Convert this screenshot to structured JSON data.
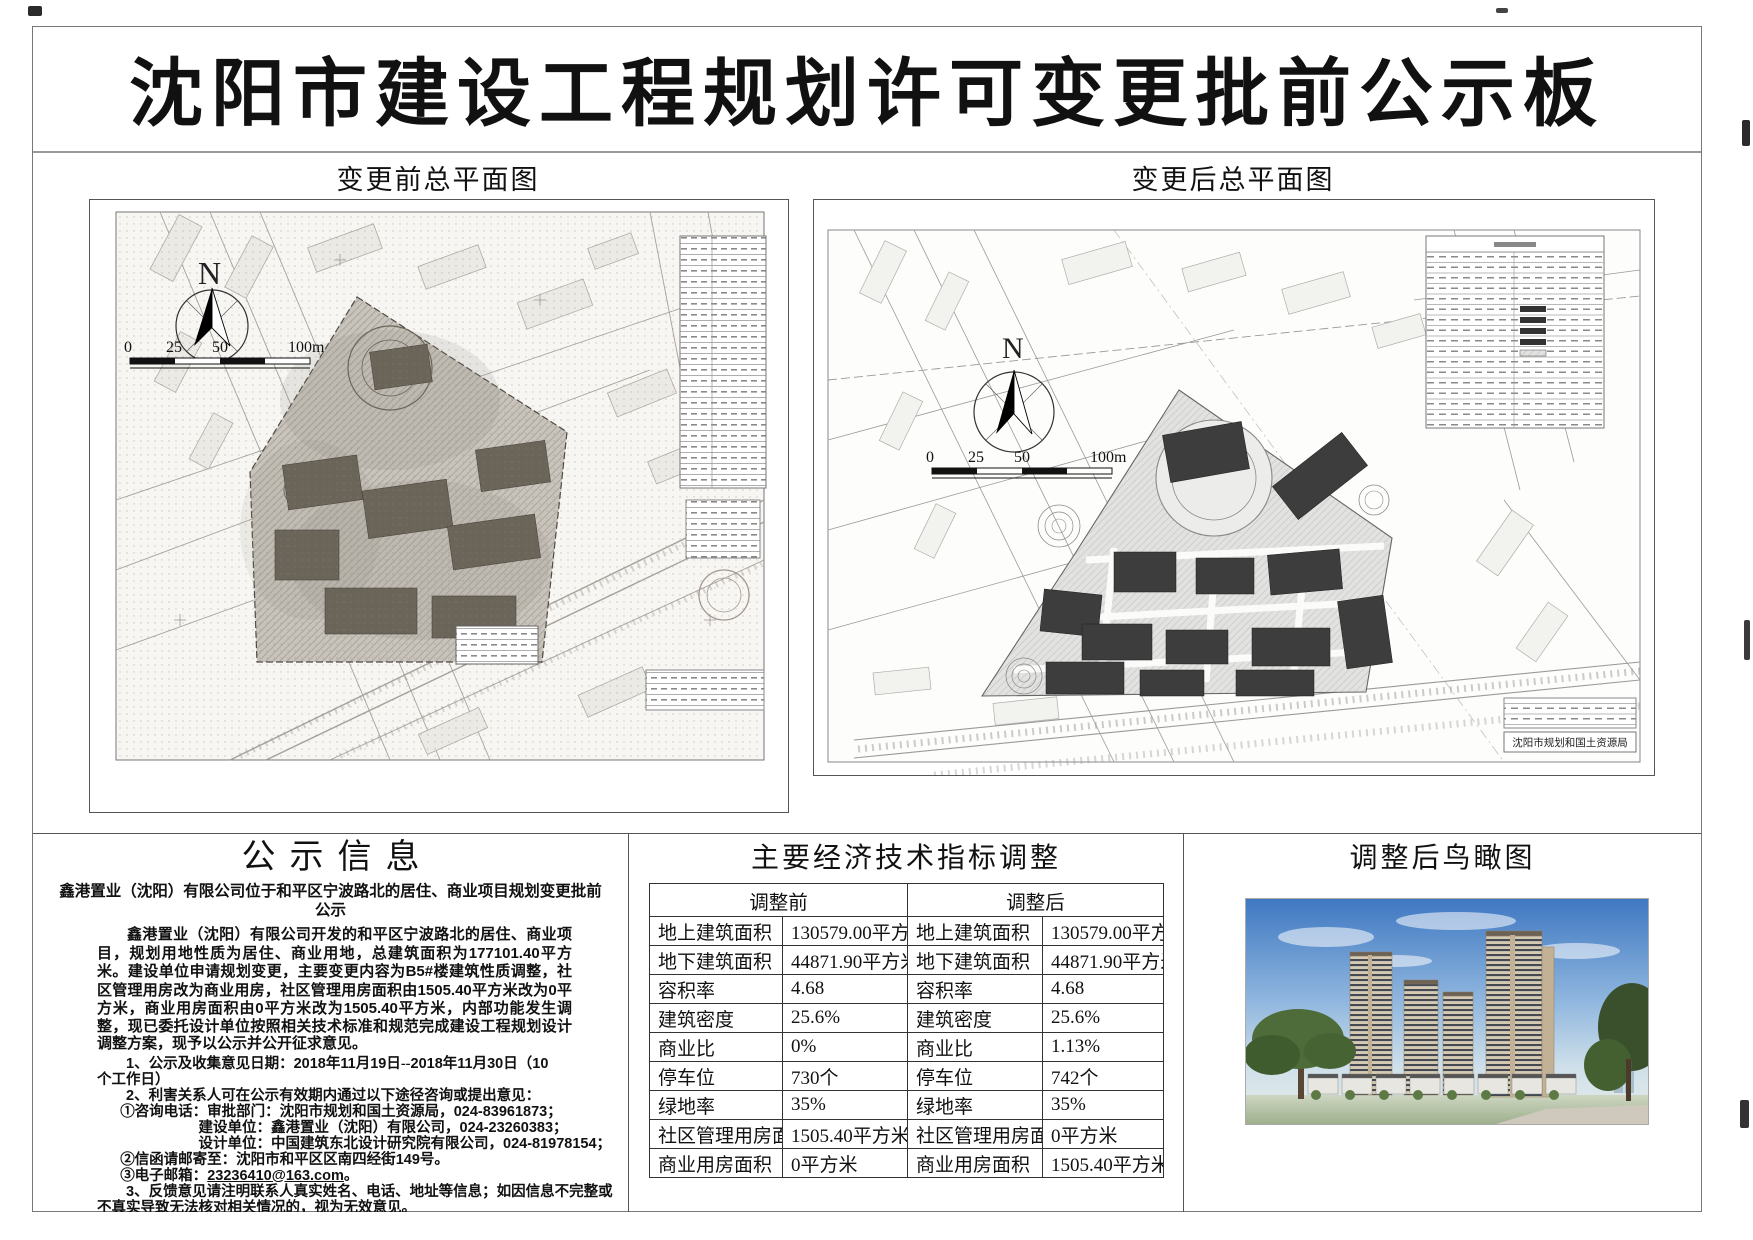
{
  "page": {
    "title": "沈阳市建设工程规划许可变更批前公示板"
  },
  "plans": {
    "before": {
      "title": "变更前总平面图",
      "north": "N",
      "scale": [
        "0",
        "25",
        "50",
        "100m"
      ]
    },
    "after": {
      "title": "变更后总平面图",
      "north": "N",
      "scale": [
        "0",
        "25",
        "50",
        "100m"
      ],
      "agency": "沈阳市规划和国土资源局"
    }
  },
  "notice": {
    "title": "公示信息",
    "subtitle": "鑫港置业（沈阳）有限公司位于和平区宁波路北的居住、商业项目规划变更批前公示",
    "paragraph": "鑫港置业（沈阳）有限公司开发的和平区宁波路北的居住、商业项目，规划用地性质为居住、商业用地，总建筑面积为177101.40平方米。建设单位申请规划变更，主要变更内容为B5#楼建筑性质调整，社区管理用房改为商业用房，社区管理用房面积由1505.40平方米改为0平方米，商业用房面积由0平方米改为1505.40平方米，内部功能发生调整，现已委托设计单位按照相关技术标准和规范完成建设工程规划设计调整方案，现予以公示并公开征求意见。",
    "items": [
      {
        "text": "1、公示及收集意见日期：2018年11月19日--2018年11月30日（10个工作日）",
        "indent": 2
      },
      {
        "text": "2、利害关系人可在公示有效期内通过以下途径咨询或提出意见：",
        "indent": 2
      },
      {
        "text": "①咨询电话：审批部门：沈阳市规划和国土资源局，024-83961873；",
        "indent": 1.6
      },
      {
        "text": "建设单位：鑫港置业（沈阳）有限公司，024-23260383；",
        "indent": 7
      },
      {
        "text": "设计单位：中国建筑东北设计研究院有限公司，024-81978154；",
        "indent": 7
      },
      {
        "text": "②信函请邮寄至：沈阳市和平区区南四经街149号。",
        "indent": 1.6
      },
      {
        "text": "③电子邮箱：23236410@163.com。",
        "indent": 1.6,
        "underline": "23236410@163.com"
      },
      {
        "text": "3、反馈意见请注明联系人真实姓名、电话、地址等信息；如因信息不完整或不真实导致无法核对相关情况的，视为无效意见。",
        "indent": 2
      },
      {
        "text": "4、本方案涉及的利害关系人依法享有听证权。",
        "indent": 2
      }
    ],
    "signature": "沈阳市规划和国土资源局",
    "date": "2018年11月19日"
  },
  "indicators": {
    "title": "主要经济技术指标调整",
    "col_before": "调整前",
    "col_after": "调整后",
    "rows": [
      {
        "label": "地上建筑面积",
        "before": "130579.00平方米",
        "after": "130579.00平方米"
      },
      {
        "label": "地下建筑面积",
        "before": "44871.90平方米",
        "after": "44871.90平方米"
      },
      {
        "label": "容积率",
        "before": "4.68",
        "after": "4.68"
      },
      {
        "label": "建筑密度",
        "before": "25.6%",
        "after": "25.6%"
      },
      {
        "label": "商业比",
        "before": "0%",
        "after": "1.13%"
      },
      {
        "label": "停车位",
        "before": "730个",
        "after": "742个"
      },
      {
        "label": "绿地率",
        "before": "35%",
        "after": "35%"
      },
      {
        "label": "社区管理用房面积",
        "before": "1505.40平方米",
        "after": "0平方米"
      },
      {
        "label": "商业用房面积",
        "before": "0平方米",
        "after": "1505.40平方米"
      }
    ]
  },
  "aerial": {
    "title": "调整后鸟瞰图"
  }
}
